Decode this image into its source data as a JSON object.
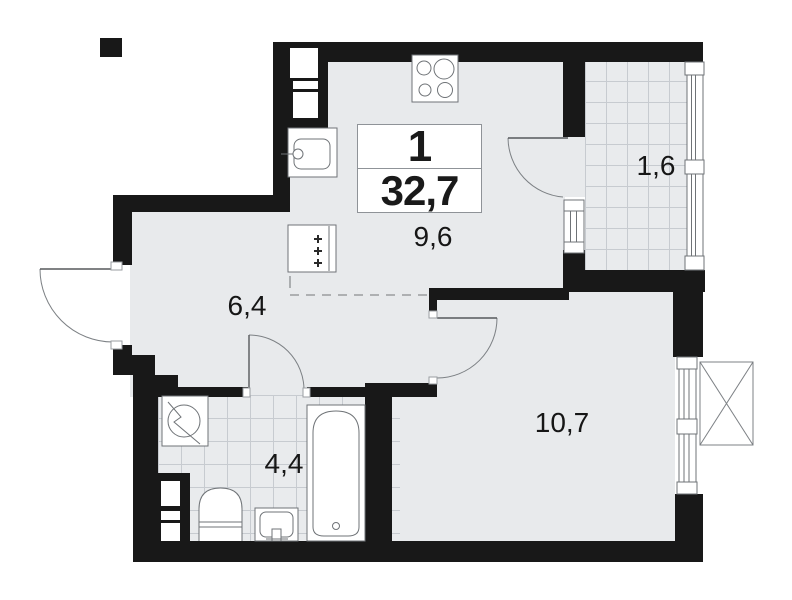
{
  "plan": {
    "unit": {
      "rooms_count": "1",
      "total_area": "32,7"
    },
    "areas": {
      "kitchen": "9,6",
      "hallway": "6,4",
      "balcony": "1,6",
      "bathroom": "4,4",
      "living_room": "10,7"
    },
    "colors": {
      "wall": "#181818",
      "floor": "#e8eaec",
      "tile_line": "#c7cbd0",
      "fixture_line": "#6f7377",
      "card_border": "#8f9398"
    },
    "icons": [
      "stove-icon",
      "fridge-icon",
      "kitchen-sink-icon",
      "washing-machine-icon",
      "toilet-icon",
      "wash-basin-icon",
      "bathtub-icon",
      "ac-basket-icon",
      "door-swing-icon",
      "window-icon"
    ]
  }
}
